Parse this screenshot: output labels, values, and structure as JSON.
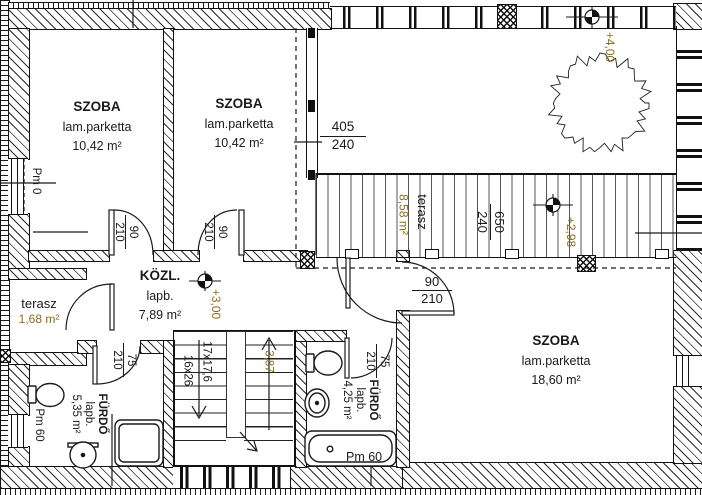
{
  "colors": {
    "accent": "#8a6b1f",
    "ink": "#1a1a1a"
  },
  "rooms": {
    "room1": {
      "name": "SZOBA",
      "floor": "lam.parketta",
      "area": "10,42 m²"
    },
    "room2": {
      "name": "SZOBA",
      "floor": "lam.parketta",
      "area": "10,42 m²"
    },
    "room3": {
      "name": "SZOBA",
      "floor": "lam.parketta",
      "area": "18,60 m²"
    },
    "hall": {
      "name": "KÖZL.",
      "floor": "lapb.",
      "area": "7,89 m²"
    },
    "bath1": {
      "name": "FÜRDŐ",
      "floor": "lapb.",
      "area": "5,35 m²"
    },
    "bath2": {
      "name": "FÜRDŐ",
      "floor": "lapb.",
      "area": "4,25 m²"
    },
    "terrace_small": {
      "name": "terasz",
      "area": "1,68 m²"
    },
    "terrace_large": {
      "name": "terasz",
      "area": "8,58 m²"
    }
  },
  "levels": {
    "upper_terrace": "+4,00",
    "terrace": "+2,98",
    "hall": "+3,00"
  },
  "stairs": {
    "flight_spec_1": "17x17,6",
    "flight_spec_2": "16x26",
    "total_rise": "3,87"
  },
  "openings": {
    "window_room2": {
      "num": "405",
      "den": "240"
    },
    "window_terrace": {
      "num": "650",
      "den": "240"
    },
    "door_room1": {
      "num": "90",
      "den": "210"
    },
    "door_room2": {
      "num": "90",
      "den": "210"
    },
    "door_room3": {
      "num": "90",
      "den": "210"
    },
    "door_bath1": {
      "num": "75",
      "den": "210"
    },
    "door_bath2": {
      "num": "75",
      "den": "210"
    }
  },
  "parapets": {
    "left_window": "Pm 0",
    "bath1_window": "Pm 60",
    "tub_window": "Pm 60"
  }
}
